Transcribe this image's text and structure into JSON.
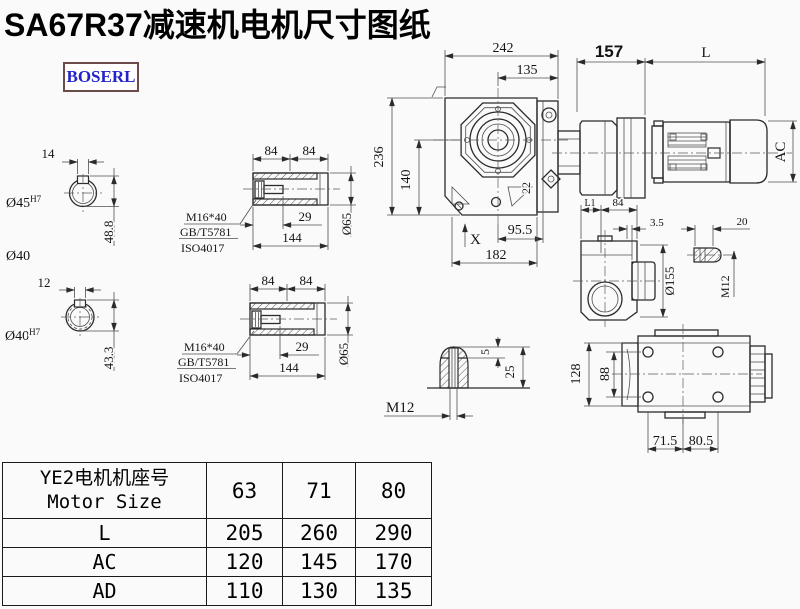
{
  "title": "SA67R37减速机电机尺寸图纸",
  "brand": "BOSERL",
  "colors": {
    "brand_text": "#2323c8",
    "brand_border": "#6b4a4a",
    "line": "#2b2b2b",
    "bg": "#fafafa"
  },
  "views": {
    "hollow_shaft_a": {
      "keyway_width": "14",
      "bore": "Ø45",
      "tol": "H7",
      "depth": "48.8",
      "note": "Ø40"
    },
    "hollow_shaft_b": {
      "keyway_width": "12",
      "bore": "Ø40",
      "tol": "H7",
      "depth": "43.3"
    },
    "sleeve": {
      "len_a": "84",
      "len_b": "84",
      "bolt": "M16*40",
      "std_gb": "GB/T5781",
      "std_iso": "ISO4017",
      "depth": "29",
      "length": "144",
      "dia": "Ø65"
    },
    "assembly": {
      "w242": "242",
      "w135": "135",
      "w157": "157",
      "motor_len": "L",
      "h236": "236",
      "h140": "140",
      "off22": "22",
      "w955": "95.5",
      "mark": "X",
      "w182": "182",
      "motor_dia": "AC"
    },
    "side": {
      "l1": "L1",
      "w84": "84",
      "g35": "3.5",
      "stub": "20",
      "flange": "Ø155",
      "thread": "M12"
    },
    "bottom": {
      "h128": "128",
      "h88": "88",
      "w715": "71.5",
      "w805": "80.5"
    },
    "key_detail": {
      "k5": "5",
      "k25": "25",
      "thread": "M12"
    }
  },
  "table": {
    "header_cn": "YE2电机机座号",
    "header_en": "Motor Size",
    "sizes": [
      "63",
      "71",
      "80"
    ],
    "rows": [
      {
        "label": "L",
        "values": [
          "205",
          "260",
          "290"
        ]
      },
      {
        "label": "AC",
        "values": [
          "120",
          "145",
          "170"
        ]
      },
      {
        "label": "AD",
        "values": [
          "110",
          "130",
          "135"
        ]
      }
    ]
  }
}
